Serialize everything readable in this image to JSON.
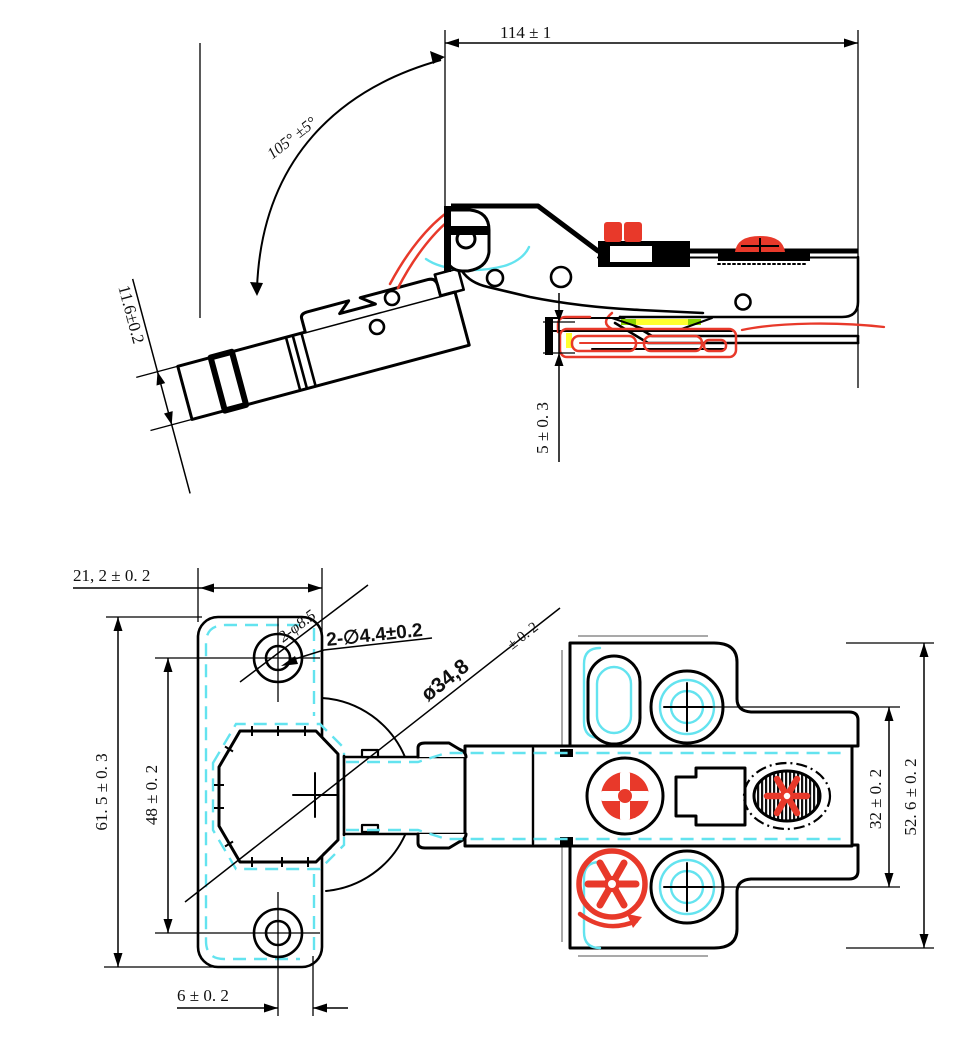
{
  "drawing": {
    "type": "technical-drawing",
    "subject": "105-degree concealed cabinet hinge with mounting plate",
    "colors": {
      "outline": "#000000",
      "highlight_red": "#e8392a",
      "highlight_cyan": "#63e3ef",
      "accent_yellow": "#ffff2e",
      "accent_green": "#8cd600",
      "background": "#ffffff"
    },
    "side_view": {
      "dim_overall_length": "114 ± 1",
      "dim_opening_angle": "105° ±5°",
      "dim_cup_depth": "11.6±0.2",
      "dim_plate_height": "5 ± 0. 3"
    },
    "plan_view": {
      "dim_flange_width": "21, 2 ± 0. 2",
      "callout_cup_holes": "2-φ8.5",
      "callout_screw_holes": "2-∅4.4±0.2",
      "callout_cup_diameter": "ø34,8",
      "callout_cup_diameter_tol": "± 0. 2",
      "dim_hole_spacing": "48 ± 0. 2",
      "dim_flange_height": "61. 5 ± 0. 3",
      "dim_edge_distance": "6 ± 0. 2",
      "dim_plate_hole_spacing": "32 ± 0. 2",
      "dim_plate_length": "52. 6 ± 0. 2"
    }
  }
}
